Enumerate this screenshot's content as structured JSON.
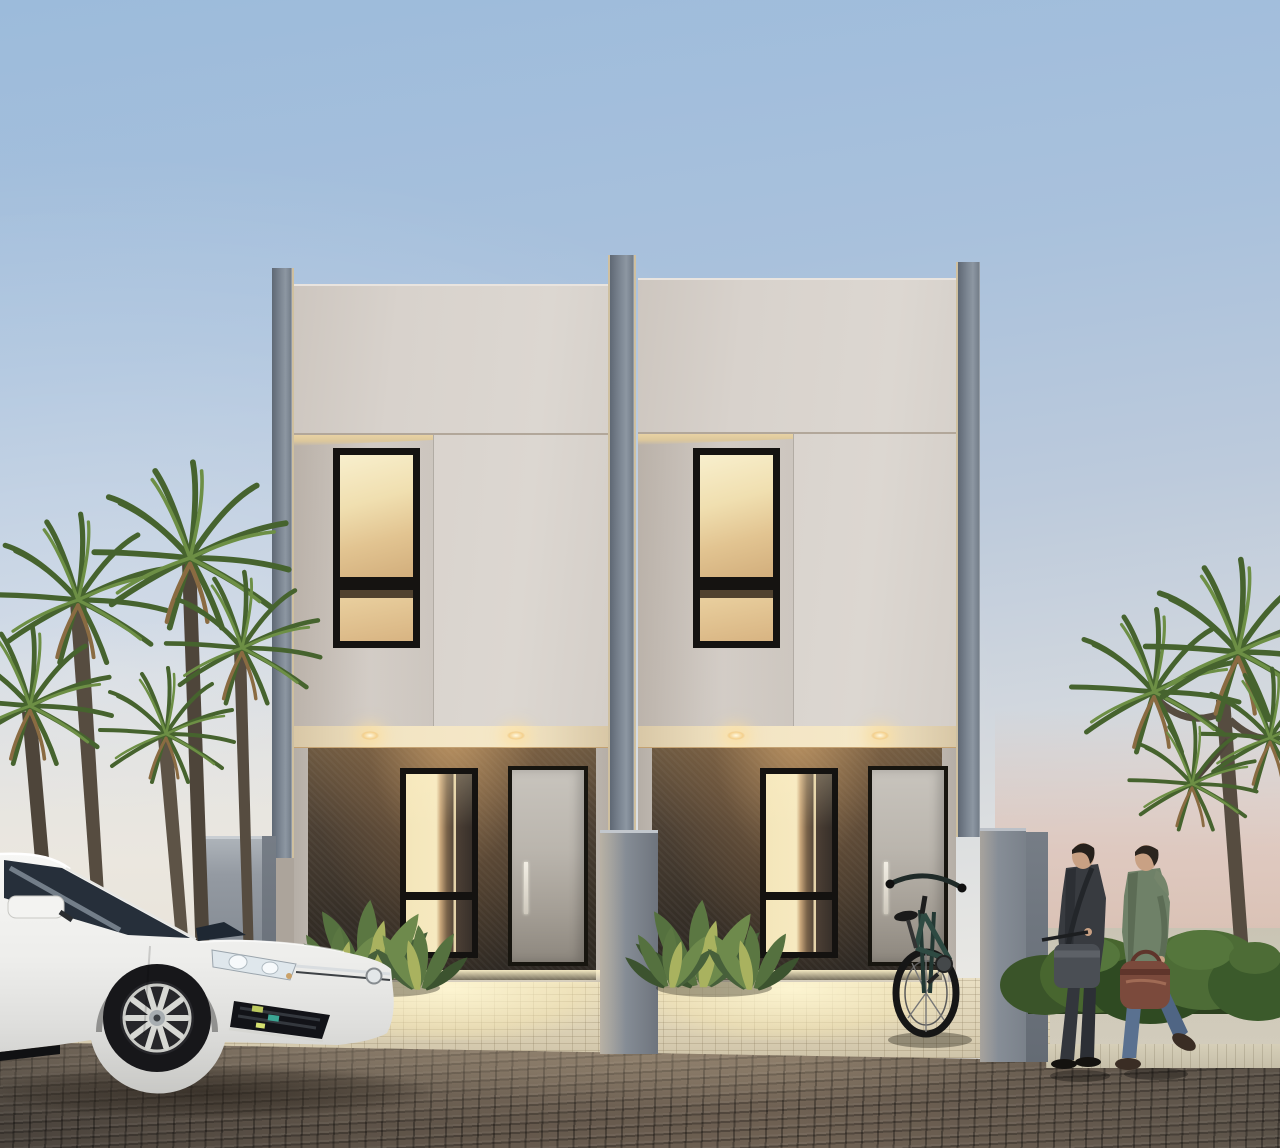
{
  "meta": {
    "title": "Dusk architectural rendering of twin two-storey minimalist houses with white hatchback, palms, bicycle and two pedestrians",
    "category": "3d-architectural-visualization",
    "time_of_day": "dusk",
    "no_visible_text": true
  },
  "palette": {
    "sky_top": "#9cbbdb",
    "sky_horizon_left": "#f0ede6",
    "haze_pink_right": "#d8bfb2",
    "facade_offwhite": "#d8d2cc",
    "pillar_gray": "#7c8692",
    "porch_wall_dark": "#362f27",
    "porch_wall_warm": "#6d5941",
    "window_frame_black": "#151311",
    "window_glow_amber": "#f0dfb0",
    "canopy_cream": "#f2e4c3",
    "door_gray": "#bab5ad",
    "boundary_wall_gray": "#858c95",
    "driveway_cream": "#e0d6bb",
    "street_brick_brown": "#63574b",
    "palm_green": "#46632e",
    "palm_trunk": "#564c40",
    "car_body_white": "#f2f2f0",
    "coat_charcoal": "#383b40",
    "jacket_green": "#6f8168",
    "jeans_blue": "#5a7190",
    "bag_brown": "#7b4a3c",
    "bike_frame_teal": "#2e4a42"
  },
  "houses": {
    "count": 2,
    "style": "modern minimalist flat-roof twin units with grey corner fins",
    "shared_features": {
      "upper_facade": "warm off-white stucco with horizontal reveal line",
      "upper_window": "black-framed two-pane window, warm interior light",
      "entry_canopy": "cream soffit with two recessed warm downlights per house",
      "ground_floor_wall": "dark textured stone, warm uplight from porch",
      "tall_glass": "black-framed full-height glazing, lit interior",
      "entry_door": "light grey slab with long vertical stainless handle",
      "forecourt": "cream concrete block paving with warm light pools"
    },
    "units": [
      {
        "id": "left-house",
        "position": "left of party fin"
      },
      {
        "id": "right-house",
        "position": "right of party fin",
        "bicycle_at_entry": true
      }
    ]
  },
  "walls": {
    "left_boundary": "grey rendered wall",
    "party_divider": "grey fin wall between driveways",
    "right_boundary": "grey rendered wall"
  },
  "vehicles": {
    "car": {
      "type": "white hatchback, front three-quarter view facing right",
      "details": [
        "LED headlight with twin rings",
        "double chrome grille strips with round badge",
        "black lower intake with teal-yellow reflections",
        "multi-spoke silver alloy wheel",
        "dark glazing with sky reflections"
      ]
    },
    "bicycle": {
      "description": "dark teal-framed bicycle leaning against right boundary wall by the entry",
      "view": "frontal, large front wheel, wide handlebar"
    }
  },
  "people": [
    {
      "id": "man-dark-coat",
      "description": "dark charcoal overcoat, grey trousers, black shoes, grey messenger bag, carrying folded umbrella",
      "walking": "right"
    },
    {
      "id": "man-green-jacket",
      "description": "sage-green hooded jacket, blue jeans, brown boots, carrying brown leather duffel bag",
      "walking": "right"
    }
  ],
  "vegetation": {
    "left": "cluster of five cordyline palms with dry brown under-fronds",
    "right": "multi-headed cordyline palm above low clipped shrubs",
    "porch_planting": "broad-leaf sage-green plants at each porch"
  },
  "ground": {
    "driveway": "cream block paving, brightly lit in front of each porch",
    "street": "dark brown brick pavers with warm sheen",
    "sidewalk_right": "pale paving strip in front of shrubs"
  },
  "lighting": {
    "windows": "warm amber interior glow",
    "downlights": "warm recessed canopy lights",
    "ambience": "cool dusk sky, pink haze at right horizon"
  }
}
